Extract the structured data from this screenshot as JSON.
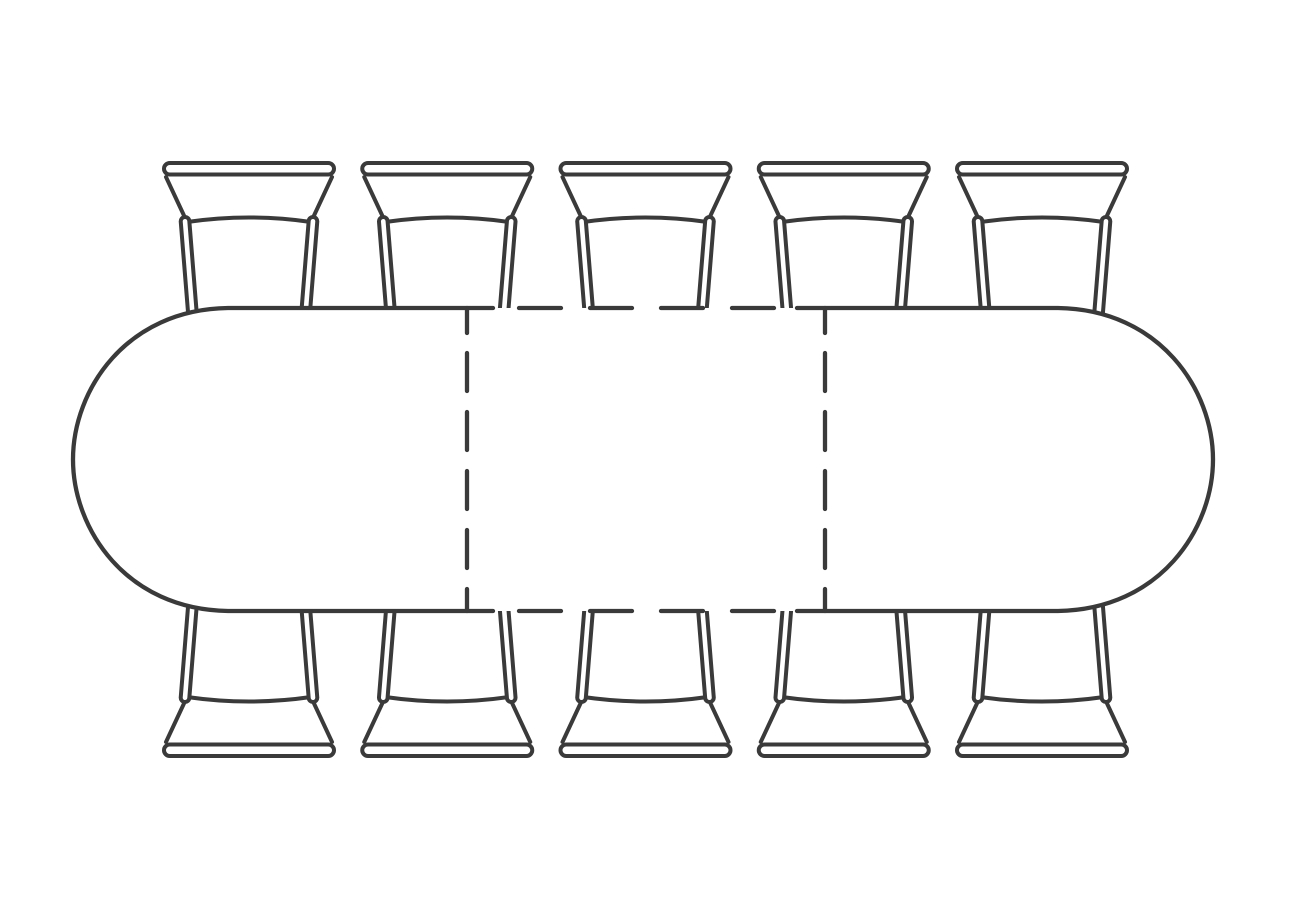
{
  "diagram": {
    "type": "furniture-plan",
    "subject": "Top view plan drawing of an oval extendable dining table with extension leaf shown as dashed lines, seating ten chairs (five per long side)",
    "text_labels": [],
    "line_color": "#3a3a3a",
    "background_color": "#ffffff"
  },
  "table": {
    "shape": "oval-extendable",
    "top_edge_y": 308,
    "bottom_edge_y": 611,
    "left_extreme_x": 73,
    "right_extreme_x": 1213,
    "straight_left_x": 228,
    "straight_right_x": 1058,
    "cap_ctrl1_dx": 102,
    "cap_ctrl1_dy": 1.5,
    "cap_ctrl2_dy": 82,
    "mid_y": 459.5,
    "solid_top_left_end_x": 493,
    "solid_top_right_start_x": 797
  },
  "leaf": {
    "divider_left_x": 467,
    "divider_right_x": 825,
    "vertical_dashes": [
      [
        308,
        333
      ],
      [
        353,
        391
      ],
      [
        412,
        450
      ],
      [
        471,
        509
      ],
      [
        530,
        568
      ],
      [
        589,
        611
      ]
    ],
    "horizontal_dashes": [
      [
        519,
        561
      ],
      [
        590,
        632
      ],
      [
        661,
        703
      ],
      [
        732,
        774
      ]
    ]
  },
  "chairs": {
    "count_total": 10,
    "count_top_row": 5,
    "count_bottom_row": 5,
    "centers_x": [
      249,
      447.25,
      645.5,
      843.75,
      1042
    ],
    "mirror_y_sum": 919
  }
}
